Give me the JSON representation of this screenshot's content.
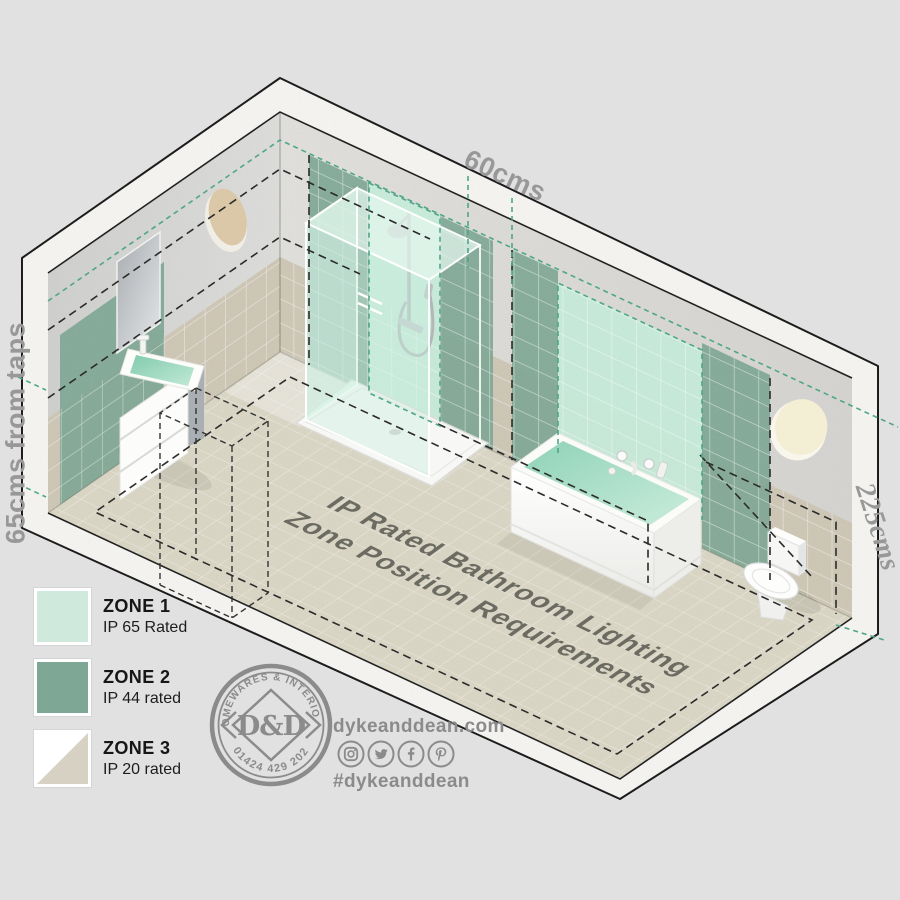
{
  "dimensions": {
    "top": "60cms",
    "left": "65cms from taps",
    "right": "225cms"
  },
  "title": {
    "line1": "IP Rated Bathroom Lighting",
    "line2": "Zone Position Requirements"
  },
  "legend": {
    "items": [
      {
        "zone": "ZONE 1",
        "rating": "IP 65 Rated",
        "color": "#cfeadd"
      },
      {
        "zone": "ZONE 2",
        "rating": "IP 44 rated",
        "color": "#7fa795"
      },
      {
        "zone": "ZONE 3",
        "rating": "IP 20 rated",
        "color": "#d6d1c3"
      }
    ]
  },
  "logo": {
    "top_text": "HOMEWARES & INTERIORS",
    "monogram": "D&D",
    "bottom_text": "01424 429 202"
  },
  "social": {
    "website": "dykeanddean.com",
    "hashtag": "#dykeanddean",
    "icons": [
      "instagram-icon",
      "twitter-icon",
      "facebook-icon",
      "pinterest-icon"
    ]
  },
  "colors": {
    "background": "#e1e1e1",
    "zone1_mint": "#c6ebda",
    "zone2_green": "#7fa795",
    "zone3_beige": "#d6d1c3",
    "wall_concrete": "#d6d6d4",
    "tile_band": "#cdc6b5",
    "floor_tile": "#dad6c4",
    "dash_teal": "#4fa68a",
    "dash_black": "#2b2b2b",
    "label_gray": "#989898",
    "brand_gray": "#8b8b8b"
  }
}
